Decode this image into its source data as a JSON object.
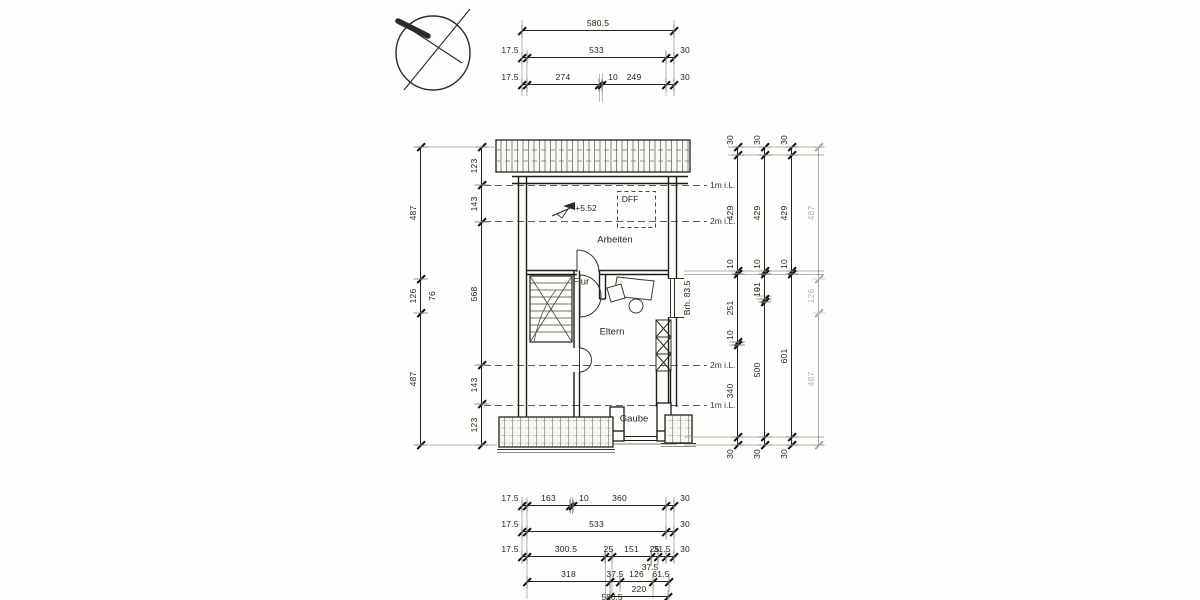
{
  "drawing": {
    "type": "attic floor plan (scanned architectural drawing)",
    "rooms": [
      {
        "name": "room-label-arbeiten",
        "text": "Arbeiten",
        "x": 615,
        "y": 240
      },
      {
        "name": "room-label-flur",
        "text": "Flur",
        "x": 581,
        "y": 282
      },
      {
        "name": "room-label-eltern",
        "text": "Eltern",
        "x": 612,
        "y": 332
      },
      {
        "name": "room-label-gaube",
        "text": "Gaube",
        "x": 634,
        "y": 419
      }
    ],
    "annotations": [
      {
        "name": "roof-window-label",
        "text": "DFF",
        "x": 630,
        "y": 199
      },
      {
        "name": "level-label",
        "text": "+5.52",
        "x": 586,
        "y": 208
      },
      {
        "name": "parapet-height-label",
        "text": "Brh. 83.5",
        "x": 687,
        "y": 298,
        "rot": true
      },
      {
        "name": "extra-dim-76",
        "text": "76",
        "x": 432,
        "y": 296,
        "rot": true
      },
      {
        "name": "extra-dim-37-5",
        "text": "37.5",
        "x": 650,
        "y": 567
      },
      {
        "name": "total-width-clipped",
        "text": "580.5",
        "x": 612,
        "y": 597
      }
    ],
    "clearance_labels": [
      {
        "name": "clearance-1m-top",
        "text": "1m i.L.",
        "x": 710,
        "y": 185
      },
      {
        "name": "clearance-2m-top",
        "text": "2m i.L.",
        "x": 710,
        "y": 221
      },
      {
        "name": "clearance-2m-bottom",
        "text": "2m i.L.",
        "x": 710,
        "y": 365
      },
      {
        "name": "clearance-1m-bottom",
        "text": "1m i.L.",
        "x": 710,
        "y": 405
      }
    ]
  },
  "dim_chains": {
    "horizontal": [
      {
        "name": "dim-top-total",
        "y": 30,
        "x0": 522,
        "segs": [
          {
            "t": "580.5",
            "px": 152
          }
        ]
      },
      {
        "name": "dim-top-533",
        "y": 57,
        "x0": 522,
        "segs": [
          {
            "t": "17.5",
            "px": 5,
            "lp": "before"
          },
          {
            "t": "533",
            "px": 139
          },
          {
            "t": "30",
            "px": 8,
            "lp": "after"
          }
        ]
      },
      {
        "name": "dim-top-274-10-249",
        "y": 84,
        "x0": 522,
        "segs": [
          {
            "t": "17.5",
            "px": 5,
            "lp": "before"
          },
          {
            "t": "274",
            "px": 72
          },
          {
            "t": "10",
            "px": 3,
            "lp": "after"
          },
          {
            "t": "249",
            "px": 64
          },
          {
            "t": "30",
            "px": 8,
            "lp": "after"
          }
        ]
      },
      {
        "name": "dim-bottom-163-10-360",
        "y": 505,
        "x0": 522,
        "segs": [
          {
            "t": "17.5",
            "px": 5,
            "lp": "before"
          },
          {
            "t": "163",
            "px": 43
          },
          {
            "t": "10",
            "px": 3,
            "lp": "after"
          },
          {
            "t": "360",
            "px": 93
          },
          {
            "t": "30",
            "px": 8,
            "lp": "after"
          }
        ]
      },
      {
        "name": "dim-bottom-533",
        "y": 531,
        "x0": 522,
        "segs": [
          {
            "t": "17.5",
            "px": 5,
            "lp": "before"
          },
          {
            "t": "533",
            "px": 139
          },
          {
            "t": "30",
            "px": 8,
            "lp": "after"
          }
        ]
      },
      {
        "name": "dim-bottom-300-25-151",
        "y": 556,
        "x0": 522,
        "segs": [
          {
            "t": "17.5",
            "px": 5,
            "lp": "before"
          },
          {
            "t": "300.5",
            "px": 78
          },
          {
            "t": "25",
            "px": 7
          },
          {
            "t": "151",
            "px": 39
          },
          {
            "t": "25",
            "px": 7
          },
          {
            "t": "31.5",
            "px": 8
          },
          {
            "t": "30",
            "px": 8,
            "lp": "after"
          }
        ]
      },
      {
        "name": "dim-bottom-318",
        "y": 581,
        "x0": 527,
        "segs": [
          {
            "t": "318",
            "px": 83
          },
          {
            "t": "37.5",
            "px": 10
          },
          {
            "t": "126",
            "px": 33
          },
          {
            "t": "61.5",
            "px": 16
          }
        ]
      },
      {
        "name": "dim-bottom-220",
        "y": 596,
        "x0": 610,
        "segs": [
          {
            "t": "220",
            "px": 58
          }
        ]
      }
    ],
    "vertical": [
      {
        "name": "dim-left-outer",
        "x": 420,
        "y0": 147,
        "segs": [
          {
            "t": "487",
            "px": 132
          },
          {
            "t": "126",
            "px": 34
          },
          {
            "t": "487",
            "px": 132
          }
        ]
      },
      {
        "name": "dim-left-inner",
        "x": 481,
        "y0": 147,
        "segs": [
          {
            "t": "123",
            "px": 38
          },
          {
            "t": "143",
            "px": 37
          },
          {
            "t": "568",
            "px": 143
          },
          {
            "t": "143",
            "px": 39
          },
          {
            "t": "123",
            "px": 41
          }
        ]
      },
      {
        "name": "dim-right-1",
        "x": 737,
        "y0": 147,
        "segs": [
          {
            "t": "30",
            "px": 8,
            "lp": "before"
          },
          {
            "t": "429",
            "px": 116
          },
          {
            "t": "10",
            "px": 3,
            "lp": "before"
          },
          {
            "t": "251",
            "px": 68
          },
          {
            "t": "10",
            "px": 3,
            "lp": "before"
          },
          {
            "t": "340",
            "px": 92
          },
          {
            "t": "30",
            "px": 8,
            "lp": "after"
          }
        ]
      },
      {
        "name": "dim-right-2",
        "x": 764,
        "y0": 147,
        "segs": [
          {
            "t": "30",
            "px": 8,
            "lp": "before"
          },
          {
            "t": "429",
            "px": 116
          },
          {
            "t": "10",
            "px": 3,
            "lp": "before"
          },
          {
            "t": "91",
            "px": 25
          },
          {
            "t": "10",
            "px": 3,
            "lp": "before"
          },
          {
            "t": "500",
            "px": 135
          },
          {
            "t": "30",
            "px": 8,
            "lp": "after"
          }
        ]
      },
      {
        "name": "dim-right-3",
        "x": 791,
        "y0": 147,
        "segs": [
          {
            "t": "30",
            "px": 8,
            "lp": "before"
          },
          {
            "t": "429",
            "px": 116
          },
          {
            "t": "10",
            "px": 3,
            "lp": "before"
          },
          {
            "t": "601",
            "px": 163
          },
          {
            "t": "30",
            "px": 8,
            "lp": "after"
          }
        ]
      },
      {
        "name": "dim-right-4",
        "x": 818,
        "y0": 147,
        "faint": true,
        "segs": [
          {
            "t": "487",
            "px": 132
          },
          {
            "t": "126",
            "px": 34
          },
          {
            "t": "487",
            "px": 132
          }
        ]
      }
    ]
  }
}
